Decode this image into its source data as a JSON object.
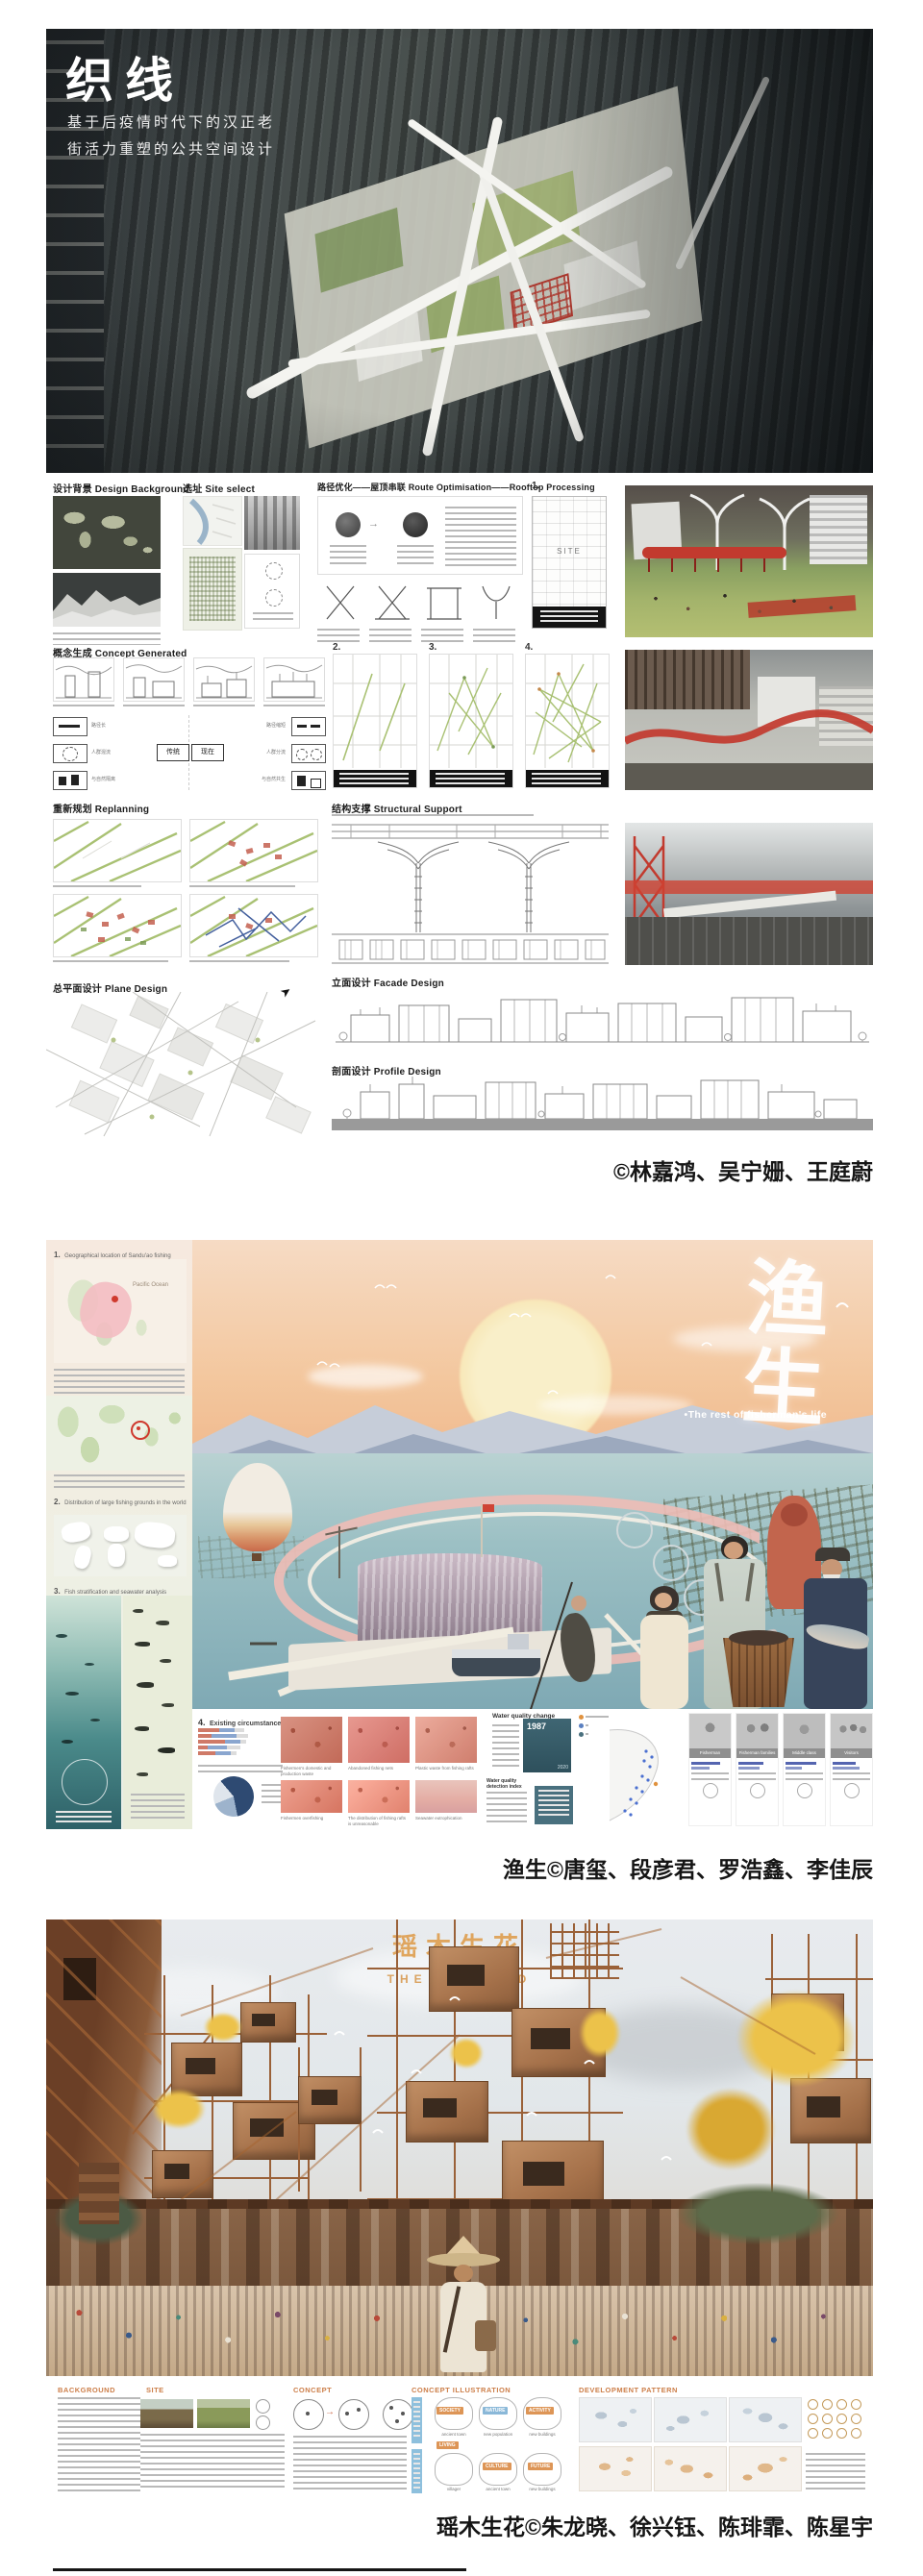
{
  "posters": [
    {
      "title": "织线",
      "subtitle_lines": [
        "基于后疫情时代下的汉正老",
        "街活力重塑的公共空间设计"
      ],
      "credit": "©林嘉鸿、吴宁姗、王庭蔚",
      "sections": {
        "design_background": "设计背景 Design Background",
        "site_select": "选址 Site select",
        "route_optimization": "路径优化——屋顶串联 Route Optimisation——Rooftop Processing",
        "concept_generated": "概念生成 Concept Generated",
        "replanning": "重新规划 Replanning",
        "structural_support": "结构支撑 Structural Support",
        "plane_design": "总平面设计 Plane Design",
        "facade_design": "立面设计 Facade Design",
        "profile_design": "剖面设计 Profile Design"
      },
      "panel_numbers": [
        "1.",
        "2.",
        "3.",
        "4."
      ],
      "labels": {
        "site": "SITE",
        "tradition": "传统",
        "present": "现在"
      },
      "comparison": {
        "left": [
          "路径长",
          "人群混流",
          "与自然隔离"
        ],
        "right": [
          "路径缩短",
          "人群分流",
          "与自然共生"
        ]
      }
    },
    {
      "title": "渔生",
      "subtitle": "•The rest of fisherman's life",
      "credit": "渔生©唐玺、段彦君、罗浩鑫、李佳辰",
      "sidebar_sections": [
        {
          "num": "1.",
          "label": "Geographical location of Sandu'ao fishing ground"
        },
        {
          "num": "2.",
          "label": "Distribution of large fishing grounds in the world"
        },
        {
          "num": "3.",
          "label": "Fish stratification and seawater analysis"
        },
        {
          "num": "4.",
          "label": "Existing circumstances"
        }
      ],
      "map_label": "Pacific Ocean",
      "issue_captions_row1": [
        "Fishermen's domestic and production waste",
        "Abandoned fishing nets",
        "Plastic waste from fishing rafts"
      ],
      "issue_captions_row2": [
        "Fishermen overfishing",
        "The distribution of fishing rafts is unreasonable",
        "Seawater eutrophication"
      ],
      "water_quality": {
        "change_title": "Water quality change",
        "year_start": "1987",
        "year_end": "2020",
        "index_title": "Water quality detection index"
      },
      "personas": [
        "Fisherman",
        "Fisherman families",
        "Middle class",
        "Visitors"
      ]
    },
    {
      "title": "瑶木生花",
      "subtitle": "THE NEW BUD",
      "credit": "瑶木生花©朱龙晓、徐兴钰、陈琲霏、陈星宇",
      "section_headers": [
        "BACKGROUND",
        "SITE",
        "CONCEPT",
        "CONCEPT ILLUSTRATION",
        "DEVELOPMENT PATTERN"
      ],
      "concept_tags": [
        "SOCIETY",
        "NATURE",
        "ACTIVITY",
        "LIVING",
        "CULTURE",
        "FUTURE"
      ],
      "tree_captions": [
        "ancient town",
        "new population",
        "new buildings",
        "villager",
        "ancient town",
        "new buildings"
      ]
    }
  ],
  "colors": {
    "accent_red": "#c0392b",
    "poster2_sun": "#f8ecc4",
    "poster3_orange": "#dfa052",
    "credit_text": "#151515"
  }
}
